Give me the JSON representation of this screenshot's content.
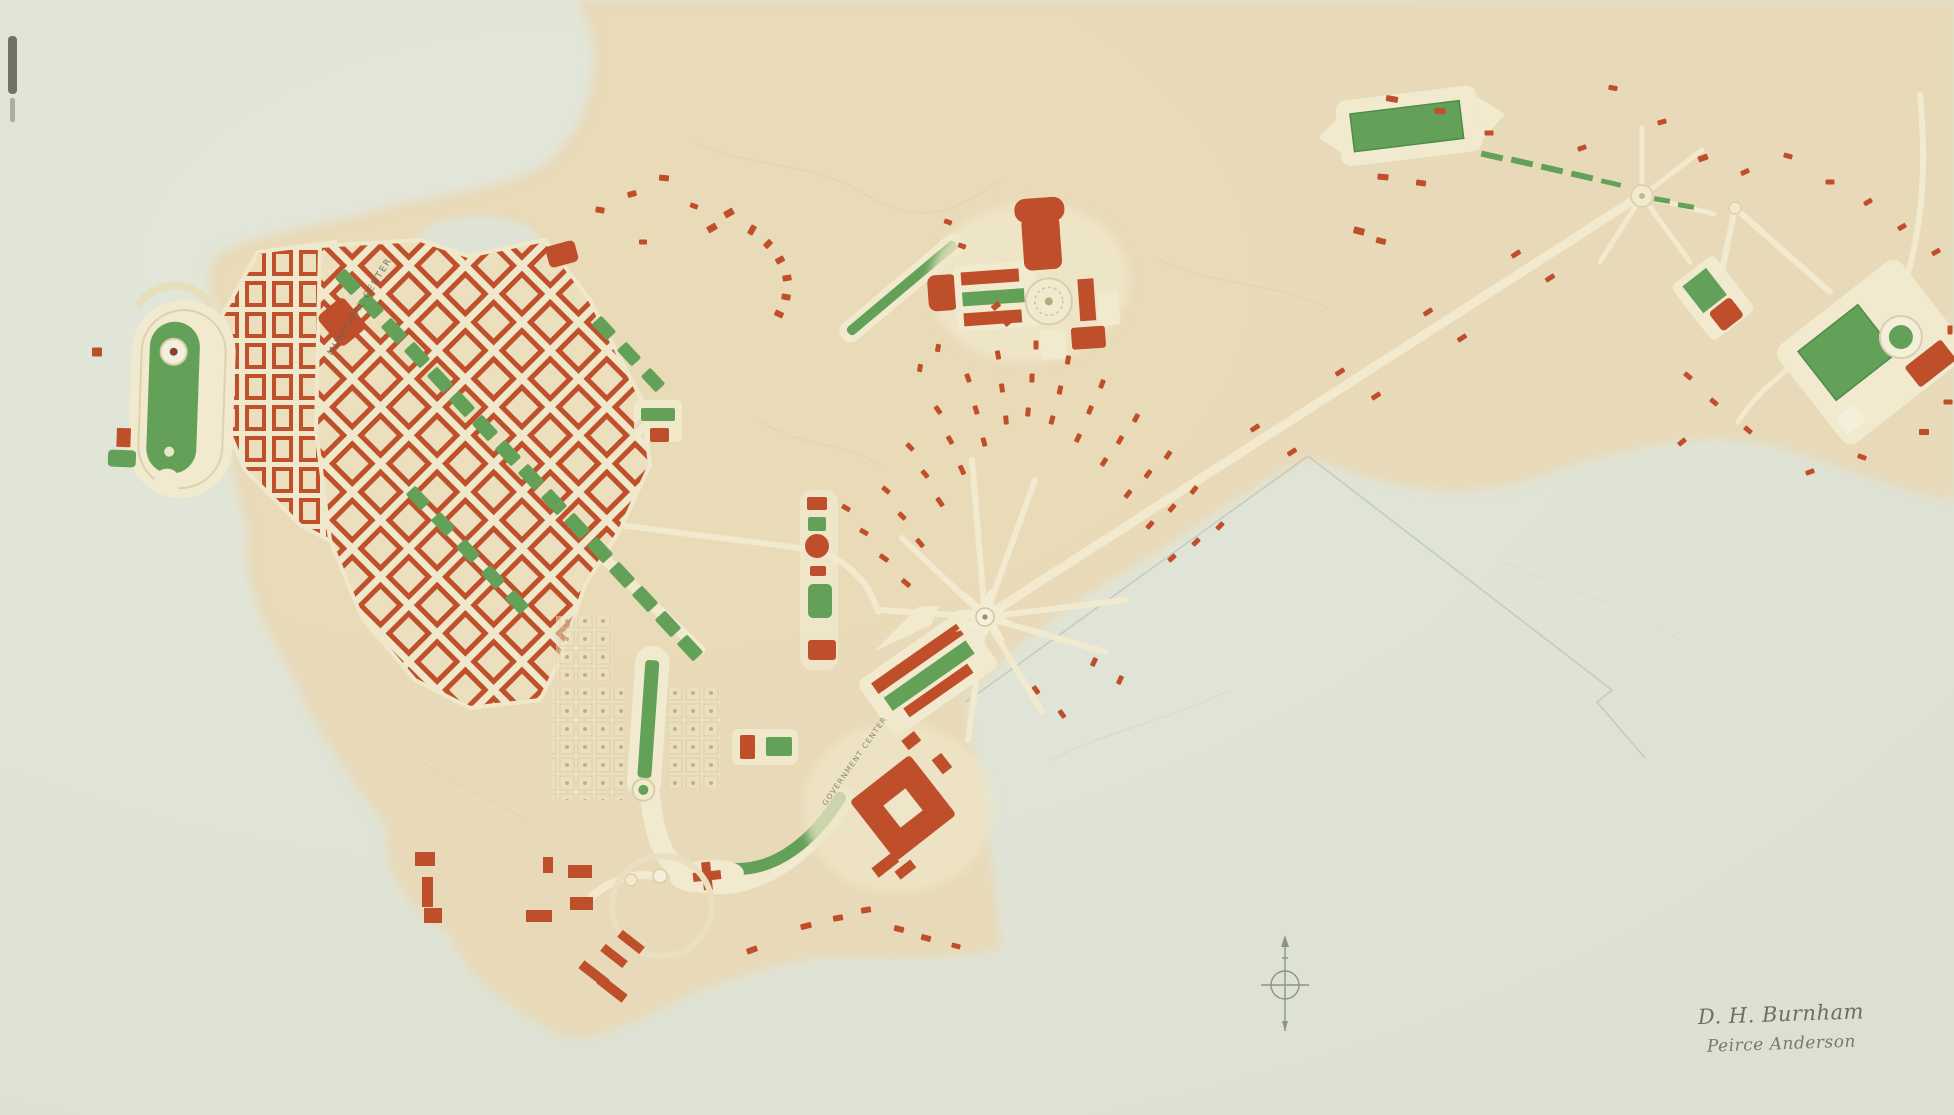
{
  "map": {
    "labels": {
      "municipal_center": "MUNICIPAL CENTER",
      "government_center": "GOVERNMENT CENTER"
    },
    "signature": {
      "line1": "D. H. Burnham",
      "line2": "Peirce Anderson"
    },
    "colors": {
      "paper": "#e0e4d6",
      "land_tan": "#e9d9b6",
      "building_red": "#bf4e2a",
      "park_green": "#63a159",
      "road_cream": "#f1eace",
      "pencil": "#878c7a"
    },
    "cottages": [
      [
        906,
        583,
        10,
        5,
        40
      ],
      [
        884,
        558,
        10,
        5,
        35
      ],
      [
        864,
        532,
        9,
        5,
        30
      ],
      [
        846,
        508,
        9,
        5,
        30
      ],
      [
        920,
        543,
        10,
        5,
        50
      ],
      [
        902,
        516,
        9,
        5,
        45
      ],
      [
        886,
        490,
        9,
        5,
        40
      ],
      [
        940,
        502,
        10,
        5,
        55
      ],
      [
        925,
        474,
        9,
        5,
        50
      ],
      [
        910,
        447,
        9,
        5,
        45
      ],
      [
        962,
        470,
        10,
        5,
        65
      ],
      [
        950,
        440,
        9,
        5,
        60
      ],
      [
        938,
        410,
        9,
        5,
        55
      ],
      [
        984,
        442,
        9,
        5,
        75
      ],
      [
        976,
        410,
        9,
        5,
        72
      ],
      [
        968,
        378,
        9,
        5,
        70
      ],
      [
        1006,
        420,
        9,
        5,
        85
      ],
      [
        1002,
        388,
        9,
        5,
        82
      ],
      [
        998,
        355,
        9,
        5,
        80
      ],
      [
        1028,
        412,
        9,
        5,
        95
      ],
      [
        1032,
        378,
        9,
        5,
        92
      ],
      [
        1036,
        345,
        9,
        5,
        90
      ],
      [
        1052,
        420,
        9,
        5,
        105
      ],
      [
        1060,
        390,
        9,
        5,
        102
      ],
      [
        1068,
        360,
        9,
        5,
        100
      ],
      [
        1078,
        438,
        9,
        5,
        115
      ],
      [
        1090,
        410,
        9,
        5,
        112
      ],
      [
        1102,
        384,
        9,
        5,
        110
      ],
      [
        1104,
        462,
        9,
        5,
        122
      ],
      [
        1120,
        440,
        9,
        5,
        120
      ],
      [
        1136,
        418,
        9,
        5,
        118
      ],
      [
        1128,
        494,
        9,
        5,
        128
      ],
      [
        1148,
        474,
        9,
        5,
        126
      ],
      [
        1168,
        455,
        9,
        5,
        124
      ],
      [
        1150,
        525,
        9,
        5,
        132
      ],
      [
        1172,
        508,
        9,
        5,
        130
      ],
      [
        1194,
        490,
        9,
        5,
        128
      ],
      [
        1172,
        558,
        9,
        5,
        138
      ],
      [
        1196,
        542,
        9,
        5,
        136
      ],
      [
        1220,
        526,
        9,
        5,
        134
      ],
      [
        948,
        222,
        8,
        5,
        20
      ],
      [
        962,
        246,
        8,
        5,
        20
      ],
      [
        938,
        348,
        8,
        5,
        100
      ],
      [
        920,
        368,
        8,
        5,
        100
      ],
      [
        600,
        210,
        9,
        6,
        10
      ],
      [
        632,
        194,
        9,
        6,
        -15
      ],
      [
        664,
        178,
        10,
        6,
        5
      ],
      [
        694,
        206,
        8,
        5,
        20
      ],
      [
        643,
        242,
        8,
        5,
        0
      ],
      [
        752,
        230,
        10,
        6,
        -60
      ],
      [
        768,
        244,
        9,
        6,
        -45
      ],
      [
        780,
        260,
        9,
        6,
        -30
      ],
      [
        787,
        278,
        9,
        6,
        -10
      ],
      [
        786,
        297,
        9,
        6,
        10
      ],
      [
        779,
        314,
        9,
        6,
        25
      ],
      [
        712,
        228,
        10,
        7,
        -30
      ],
      [
        729,
        213,
        10,
        7,
        -30
      ],
      [
        1008,
        322,
        9,
        6,
        -40
      ],
      [
        996,
        306,
        9,
        6,
        -40
      ],
      [
        1036,
        690,
        9,
        5,
        55
      ],
      [
        1062,
        714,
        9,
        5,
        55
      ],
      [
        1094,
        662,
        9,
        5,
        115
      ],
      [
        1120,
        680,
        9,
        5,
        115
      ],
      [
        1255,
        428,
        10,
        5,
        -33
      ],
      [
        1292,
        452,
        10,
        5,
        -33
      ],
      [
        1340,
        372,
        10,
        5,
        -33
      ],
      [
        1376,
        396,
        10,
        5,
        -33
      ],
      [
        1428,
        312,
        10,
        5,
        -33
      ],
      [
        1462,
        338,
        10,
        5,
        -33
      ],
      [
        1516,
        254,
        10,
        5,
        -33
      ],
      [
        1550,
        278,
        10,
        5,
        -33
      ],
      [
        1392,
        99,
        12,
        6,
        10
      ],
      [
        1440,
        111,
        11,
        6,
        5
      ],
      [
        1383,
        177,
        11,
        6,
        5
      ],
      [
        1421,
        183,
        10,
        6,
        8
      ],
      [
        1489,
        133,
        9,
        5,
        0
      ],
      [
        1582,
        148,
        9,
        5,
        -20
      ],
      [
        1613,
        88,
        9,
        5,
        10
      ],
      [
        1662,
        122,
        9,
        5,
        -15
      ],
      [
        1703,
        158,
        10,
        6,
        -20
      ],
      [
        1745,
        172,
        9,
        5,
        -25
      ],
      [
        1788,
        156,
        9,
        5,
        15
      ],
      [
        1359,
        231,
        11,
        7,
        15
      ],
      [
        1381,
        241,
        10,
        6,
        15
      ],
      [
        1830,
        182,
        9,
        5,
        0
      ],
      [
        1868,
        202,
        9,
        5,
        -30
      ],
      [
        1902,
        227,
        9,
        5,
        -30
      ],
      [
        1936,
        252,
        9,
        5,
        -30
      ],
      [
        1688,
        376,
        9,
        5,
        40
      ],
      [
        1714,
        402,
        9,
        5,
        40
      ],
      [
        1748,
        430,
        9,
        5,
        40
      ],
      [
        1682,
        442,
        9,
        5,
        -40
      ],
      [
        1924,
        432,
        10,
        6,
        0
      ],
      [
        1948,
        402,
        9,
        5,
        0
      ],
      [
        1862,
        457,
        9,
        5,
        20
      ],
      [
        1810,
        472,
        9,
        5,
        -20
      ],
      [
        1950,
        330,
        9,
        5,
        90
      ],
      [
        752,
        950,
        11,
        6,
        -20
      ],
      [
        806,
        926,
        11,
        6,
        -15
      ],
      [
        838,
        918,
        10,
        6,
        -10
      ],
      [
        866,
        910,
        10,
        6,
        -10
      ],
      [
        899,
        929,
        10,
        6,
        15
      ],
      [
        926,
        938,
        10,
        6,
        15
      ],
      [
        956,
        946,
        9,
        5,
        15
      ],
      [
        97,
        352,
        10,
        9,
        0
      ]
    ],
    "avenue_blocks_main": [
      [
        348,
        282
      ],
      [
        371,
        306
      ],
      [
        394,
        331
      ],
      [
        417,
        355
      ],
      [
        440,
        380
      ],
      [
        462,
        404
      ],
      [
        485,
        428
      ],
      [
        508,
        453
      ],
      [
        531,
        477
      ],
      [
        554,
        502
      ],
      [
        577,
        526
      ],
      [
        600,
        550
      ],
      [
        622,
        575
      ],
      [
        645,
        599
      ],
      [
        668,
        624
      ],
      [
        690,
        648
      ]
    ],
    "avenue_blocks_second": [
      [
        418,
        498
      ],
      [
        443,
        524
      ],
      [
        468,
        551
      ],
      [
        493,
        577
      ],
      [
        517,
        602
      ]
    ],
    "avenue_blocks_east": [
      [
        604,
        328
      ],
      [
        629,
        354
      ],
      [
        653,
        380
      ]
    ]
  }
}
